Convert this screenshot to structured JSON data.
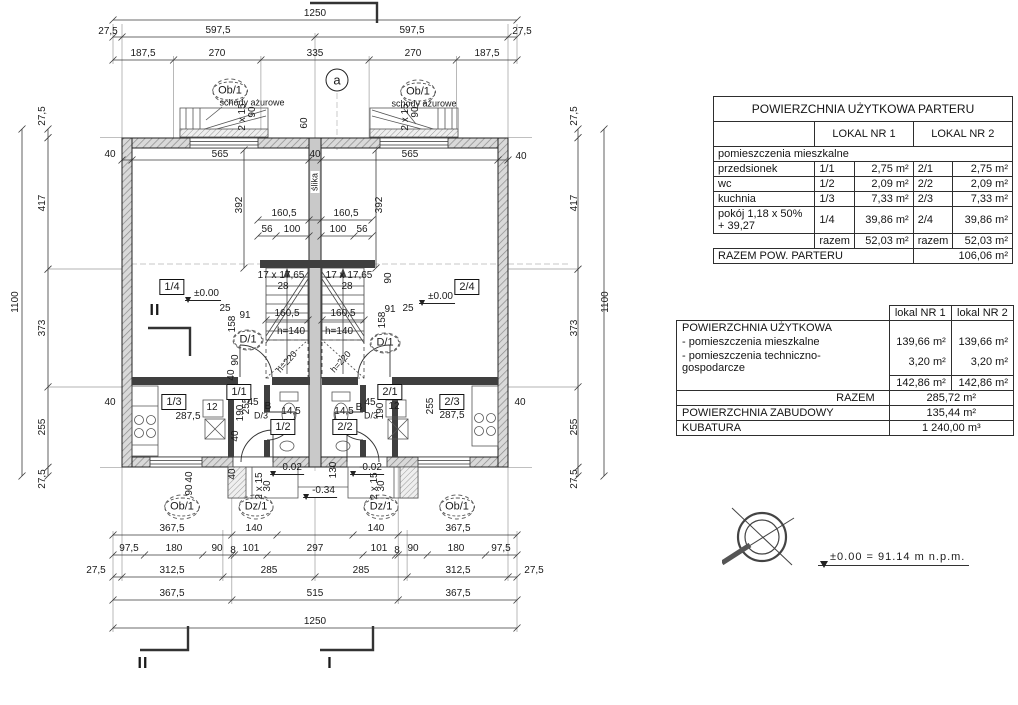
{
  "tables": {
    "parter": {
      "title": "POWIERZCHNIA UŻYTKOWA PARTERU",
      "col1": "LOKAL NR 1",
      "col2": "LOKAL NR 2",
      "section": "pomieszczenia mieszkalne",
      "rows": [
        {
          "name": "przedsionek",
          "no1": "1/1",
          "val1": "2,75 m²",
          "no2": "2/1",
          "val2": "2,75 m²"
        },
        {
          "name": "wc",
          "no1": "1/2",
          "val1": "2,09 m²",
          "no2": "2/2",
          "val2": "2,09 m²"
        },
        {
          "name": "kuchnia",
          "no1": "1/3",
          "val1": "7,33 m²",
          "no2": "2/3",
          "val2": "7,33 m²"
        },
        {
          "name": "pokój 1,18 x 50% + 39,27",
          "no1": "1/4",
          "val1": "39,86 m²",
          "no2": "2/4",
          "val2": "39,86 m²"
        }
      ],
      "razem": {
        "l1": "razem",
        "v1": "52,03 m²",
        "l2": "razem",
        "v2": "52,03 m²"
      },
      "total": {
        "label": "RAZEM POW. PARTERU",
        "value": "106,06 m²"
      }
    },
    "summary": {
      "col1": "lokal NR 1",
      "col2": "lokal NR 2",
      "title": "POWIERZCHNIA UŻYTKOWA",
      "rows": [
        {
          "name": "- pomieszczenia mieszkalne",
          "val1": "139,66 m²",
          "val2": "139,66 m²"
        },
        {
          "name": "- pomieszczenia techniczno-gospodarcze",
          "val1": "3,20 m²",
          "val2": "3,20 m²"
        }
      ],
      "subtotal": {
        "val1": "142,86 m²",
        "val2": "142,86 m²"
      },
      "razem": {
        "label": "RAZEM",
        "value": "285,72 m²"
      },
      "zabudowa": {
        "label": "POWIERZCHNIA ZABUDOWY",
        "value": "135,44 m²"
      },
      "kubatura": {
        "label": "KUBATURA",
        "value": "1 240,00 m³"
      }
    }
  },
  "level_note": {
    "text": "±0.00  =  91.14  m  n.p.m."
  },
  "plan": {
    "labels": [
      {
        "t": "1250",
        "x": 315,
        "y": 14,
        "c": "dim"
      },
      {
        "t": "27,5",
        "x": 108,
        "y": 32,
        "c": "dim"
      },
      {
        "t": "597,5",
        "x": 218,
        "y": 31,
        "c": "dim"
      },
      {
        "t": "597,5",
        "x": 412,
        "y": 31,
        "c": "dim"
      },
      {
        "t": "27,5",
        "x": 522,
        "y": 32,
        "c": "dim"
      },
      {
        "t": "187,5",
        "x": 143,
        "y": 54,
        "c": "dim"
      },
      {
        "t": "270",
        "x": 217,
        "y": 54,
        "c": "dim"
      },
      {
        "t": "335",
        "x": 315,
        "y": 54,
        "c": "dim"
      },
      {
        "t": "270",
        "x": 413,
        "y": 54,
        "c": "dim"
      },
      {
        "t": "187,5",
        "x": 487,
        "y": 54,
        "c": "dim"
      },
      {
        "t": "a",
        "x": 337,
        "y": 80,
        "c": "circa"
      },
      {
        "t": "Ob/1",
        "x": 230,
        "y": 91,
        "c": "circ"
      },
      {
        "t": "Ob/1",
        "x": 418,
        "y": 92,
        "c": "circ"
      },
      {
        "t": "schody ażurowe",
        "x": 252,
        "y": 103,
        "c": "note"
      },
      {
        "t": "schody ażurowe",
        "x": 424,
        "y": 104,
        "c": "note"
      },
      {
        "t": "2 x 15",
        "x": 243,
        "y": 117,
        "c": "dimv"
      },
      {
        "t": "90",
        "x": 253,
        "y": 112,
        "c": "dimv"
      },
      {
        "t": "60",
        "x": 305,
        "y": 123,
        "c": "dimv"
      },
      {
        "t": "2 x 15",
        "x": 406,
        "y": 117,
        "c": "dimv"
      },
      {
        "t": "90",
        "x": 416,
        "y": 112,
        "c": "dimv"
      },
      {
        "t": "40",
        "x": 110,
        "y": 155,
        "c": "dim"
      },
      {
        "t": "565",
        "x": 220,
        "y": 155,
        "c": "dim"
      },
      {
        "t": "40",
        "x": 315,
        "y": 155,
        "c": "dim"
      },
      {
        "t": "565",
        "x": 410,
        "y": 155,
        "c": "dim"
      },
      {
        "t": "40",
        "x": 521,
        "y": 157,
        "c": "dim"
      },
      {
        "t": "27,5",
        "x": 43,
        "y": 116,
        "c": "dimv"
      },
      {
        "t": "417",
        "x": 43,
        "y": 203,
        "c": "dimv"
      },
      {
        "t": "1100",
        "x": 16,
        "y": 302,
        "c": "dimv"
      },
      {
        "t": "373",
        "x": 43,
        "y": 328,
        "c": "dimv"
      },
      {
        "t": "255",
        "x": 43,
        "y": 427,
        "c": "dimv"
      },
      {
        "t": "27,5",
        "x": 43,
        "y": 479,
        "c": "dimv"
      },
      {
        "t": "40",
        "x": 110,
        "y": 403,
        "c": "dim"
      },
      {
        "t": "27,5",
        "x": 575,
        "y": 116,
        "c": "dimv"
      },
      {
        "t": "417",
        "x": 575,
        "y": 203,
        "c": "dimv"
      },
      {
        "t": "1100",
        "x": 606,
        "y": 302,
        "c": "dimv"
      },
      {
        "t": "373",
        "x": 575,
        "y": 328,
        "c": "dimv"
      },
      {
        "t": "255",
        "x": 575,
        "y": 427,
        "c": "dimv"
      },
      {
        "t": "27,5",
        "x": 575,
        "y": 479,
        "c": "dimv"
      },
      {
        "t": "40",
        "x": 520,
        "y": 403,
        "c": "dim"
      },
      {
        "t": "392",
        "x": 240,
        "y": 205,
        "c": "dimv"
      },
      {
        "t": "392",
        "x": 380,
        "y": 205,
        "c": "dimv"
      },
      {
        "t": "ślika",
        "x": 315,
        "y": 182,
        "c": "notev"
      },
      {
        "t": "160,5",
        "x": 284,
        "y": 214,
        "c": "dim"
      },
      {
        "t": "160,5",
        "x": 346,
        "y": 214,
        "c": "dim"
      },
      {
        "t": "56",
        "x": 267,
        "y": 230,
        "c": "dim"
      },
      {
        "t": "100",
        "x": 292,
        "y": 230,
        "c": "dim"
      },
      {
        "t": "100",
        "x": 338,
        "y": 230,
        "c": "dim"
      },
      {
        "t": "56",
        "x": 362,
        "y": 230,
        "c": "dim"
      },
      {
        "t": "17 x 17,65",
        "x": 281,
        "y": 276,
        "c": "dim"
      },
      {
        "t": "28",
        "x": 283,
        "y": 287,
        "c": "dim"
      },
      {
        "t": "17 x 17,65",
        "x": 349,
        "y": 276,
        "c": "dim"
      },
      {
        "t": "28",
        "x": 347,
        "y": 287,
        "c": "dim"
      },
      {
        "t": "90",
        "x": 389,
        "y": 278,
        "c": "dimv"
      },
      {
        "t": "1/4",
        "x": 172,
        "y": 287,
        "c": "room"
      },
      {
        "t": "2/4",
        "x": 467,
        "y": 287,
        "c": "room"
      },
      {
        "t": "±0.00",
        "x": 203,
        "y": 295,
        "c": "level"
      },
      {
        "t": "±0.00",
        "x": 437,
        "y": 298,
        "c": "level"
      },
      {
        "t": "II",
        "x": 155,
        "y": 311,
        "c": "sec"
      },
      {
        "t": "25",
        "x": 225,
        "y": 309,
        "c": "dim"
      },
      {
        "t": "91",
        "x": 245,
        "y": 316,
        "c": "dim"
      },
      {
        "t": "158",
        "x": 233,
        "y": 324,
        "c": "dimv"
      },
      {
        "t": "25",
        "x": 408,
        "y": 309,
        "c": "dim"
      },
      {
        "t": "91",
        "x": 390,
        "y": 310,
        "c": "dim"
      },
      {
        "t": "158",
        "x": 383,
        "y": 320,
        "c": "dimv"
      },
      {
        "t": "D/1",
        "x": 248,
        "y": 340,
        "c": "circ"
      },
      {
        "t": "D/1",
        "x": 385,
        "y": 343,
        "c": "circ"
      },
      {
        "t": "160,5",
        "x": 287,
        "y": 314,
        "c": "dim"
      },
      {
        "t": "160,5",
        "x": 343,
        "y": 314,
        "c": "dim"
      },
      {
        "t": "h=140",
        "x": 291,
        "y": 332,
        "c": "dim"
      },
      {
        "t": "h=140",
        "x": 339,
        "y": 332,
        "c": "dim"
      },
      {
        "t": "h=220",
        "x": 287,
        "y": 362,
        "c": "dim45"
      },
      {
        "t": "h=220",
        "x": 341,
        "y": 362,
        "c": "dim45"
      },
      {
        "t": "90",
        "x": 236,
        "y": 360,
        "c": "dimv"
      },
      {
        "t": "40",
        "x": 232,
        "y": 375,
        "c": "dimv"
      },
      {
        "t": "1/3",
        "x": 174,
        "y": 402,
        "c": "room"
      },
      {
        "t": "287,5",
        "x": 188,
        "y": 417,
        "c": "dim"
      },
      {
        "t": "255",
        "x": 247,
        "y": 406,
        "c": "dimv"
      },
      {
        "t": "12",
        "x": 212,
        "y": 408,
        "c": "dim"
      },
      {
        "t": "1/1",
        "x": 239,
        "y": 392,
        "c": "room"
      },
      {
        "t": "190",
        "x": 241,
        "y": 413,
        "c": "dimv"
      },
      {
        "t": "45",
        "x": 253,
        "y": 403,
        "c": "dim"
      },
      {
        "t": "B",
        "x": 268,
        "y": 407,
        "c": "dim"
      },
      {
        "t": "D/3",
        "x": 261,
        "y": 416,
        "c": "note"
      },
      {
        "t": "1/2",
        "x": 283,
        "y": 427,
        "c": "room"
      },
      {
        "t": "14,5",
        "x": 291,
        "y": 412,
        "c": "dim"
      },
      {
        "t": "40",
        "x": 236,
        "y": 436,
        "c": "dimv"
      },
      {
        "t": "2/2",
        "x": 345,
        "y": 427,
        "c": "room"
      },
      {
        "t": "14,5",
        "x": 344,
        "y": 412,
        "c": "dim"
      },
      {
        "t": "D/3",
        "x": 371,
        "y": 416,
        "c": "note"
      },
      {
        "t": "B",
        "x": 359,
        "y": 408,
        "c": "dim"
      },
      {
        "t": "45",
        "x": 370,
        "y": 403,
        "c": "dim"
      },
      {
        "t": "2/1",
        "x": 390,
        "y": 392,
        "c": "room"
      },
      {
        "t": "190",
        "x": 381,
        "y": 411,
        "c": "dimv"
      },
      {
        "t": "12",
        "x": 394,
        "y": 407,
        "c": "dim"
      },
      {
        "t": "2/3",
        "x": 452,
        "y": 402,
        "c": "room"
      },
      {
        "t": "287,5",
        "x": 452,
        "y": 416,
        "c": "dim"
      },
      {
        "t": "255",
        "x": 431,
        "y": 406,
        "c": "dimv"
      },
      {
        "t": "40",
        "x": 233,
        "y": 474,
        "c": "dimv"
      },
      {
        "t": "130",
        "x": 334,
        "y": 470,
        "c": "dimv"
      },
      {
        "t": "40",
        "x": 190,
        "y": 477,
        "c": "dimv"
      },
      {
        "t": "90",
        "x": 190,
        "y": 490,
        "c": "dimv"
      },
      {
        "t": "-0.02",
        "x": 287,
        "y": 469,
        "c": "level"
      },
      {
        "t": "-0.02",
        "x": 367,
        "y": 469,
        "c": "level"
      },
      {
        "t": "-0.34",
        "x": 320,
        "y": 492,
        "c": "level"
      },
      {
        "t": "2 x 15",
        "x": 260,
        "y": 486,
        "c": "dimv"
      },
      {
        "t": "30",
        "x": 268,
        "y": 486,
        "c": "dimv"
      },
      {
        "t": "2 x 15",
        "x": 375,
        "y": 486,
        "c": "dimv"
      },
      {
        "t": "30",
        "x": 382,
        "y": 486,
        "c": "dimv"
      },
      {
        "t": "Ob/1",
        "x": 182,
        "y": 507,
        "c": "circ"
      },
      {
        "t": "Dz/1",
        "x": 256,
        "y": 507,
        "c": "circ"
      },
      {
        "t": "Dz/1",
        "x": 381,
        "y": 507,
        "c": "circ"
      },
      {
        "t": "Ob/1",
        "x": 457,
        "y": 507,
        "c": "circ"
      },
      {
        "t": "367,5",
        "x": 172,
        "y": 529,
        "c": "dim"
      },
      {
        "t": "140",
        "x": 254,
        "y": 529,
        "c": "dim"
      },
      {
        "t": "140",
        "x": 376,
        "y": 529,
        "c": "dim"
      },
      {
        "t": "367,5",
        "x": 458,
        "y": 529,
        "c": "dim"
      },
      {
        "t": "97,5",
        "x": 129,
        "y": 549,
        "c": "dim"
      },
      {
        "t": "180",
        "x": 174,
        "y": 549,
        "c": "dim"
      },
      {
        "t": "90",
        "x": 217,
        "y": 549,
        "c": "dim"
      },
      {
        "t": "8",
        "x": 233,
        "y": 551,
        "c": "dim"
      },
      {
        "t": "101",
        "x": 251,
        "y": 549,
        "c": "dim"
      },
      {
        "t": "297",
        "x": 315,
        "y": 549,
        "c": "dim"
      },
      {
        "t": "101",
        "x": 379,
        "y": 549,
        "c": "dim"
      },
      {
        "t": "8",
        "x": 397,
        "y": 551,
        "c": "dim"
      },
      {
        "t": "90",
        "x": 413,
        "y": 549,
        "c": "dim"
      },
      {
        "t": "180",
        "x": 456,
        "y": 549,
        "c": "dim"
      },
      {
        "t": "97,5",
        "x": 501,
        "y": 549,
        "c": "dim"
      },
      {
        "t": "27,5",
        "x": 96,
        "y": 571,
        "c": "dim"
      },
      {
        "t": "312,5",
        "x": 172,
        "y": 571,
        "c": "dim"
      },
      {
        "t": "285",
        "x": 269,
        "y": 571,
        "c": "dim"
      },
      {
        "t": "285",
        "x": 361,
        "y": 571,
        "c": "dim"
      },
      {
        "t": "312,5",
        "x": 458,
        "y": 571,
        "c": "dim"
      },
      {
        "t": "27,5",
        "x": 534,
        "y": 571,
        "c": "dim"
      },
      {
        "t": "367,5",
        "x": 172,
        "y": 594,
        "c": "dim"
      },
      {
        "t": "515",
        "x": 315,
        "y": 594,
        "c": "dim"
      },
      {
        "t": "367,5",
        "x": 458,
        "y": 594,
        "c": "dim"
      },
      {
        "t": "1250",
        "x": 315,
        "y": 622,
        "c": "dim"
      },
      {
        "t": "II",
        "x": 143,
        "y": 664,
        "c": "sec"
      },
      {
        "t": "I",
        "x": 330,
        "y": 664,
        "c": "sec"
      }
    ]
  }
}
